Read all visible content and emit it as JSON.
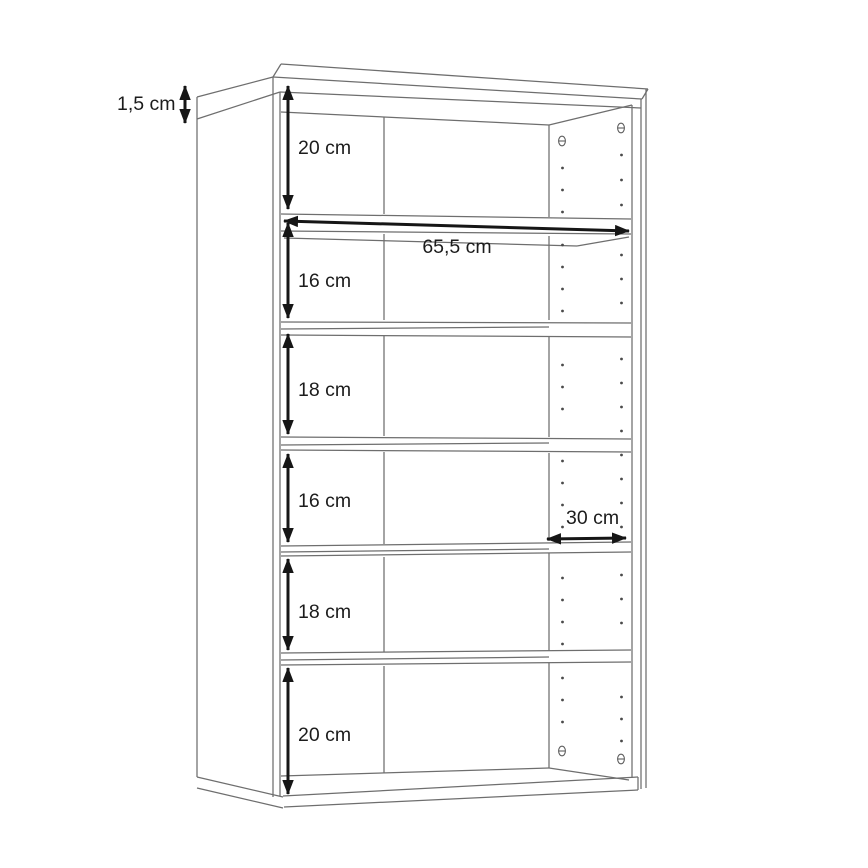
{
  "diagram": {
    "dimensions": {
      "top_thickness": "1,5 cm",
      "width": "65,5 cm",
      "depth": "30 cm",
      "compartments": [
        "20 cm",
        "16 cm",
        "18 cm",
        "16 cm",
        "18 cm",
        "20 cm"
      ]
    }
  }
}
